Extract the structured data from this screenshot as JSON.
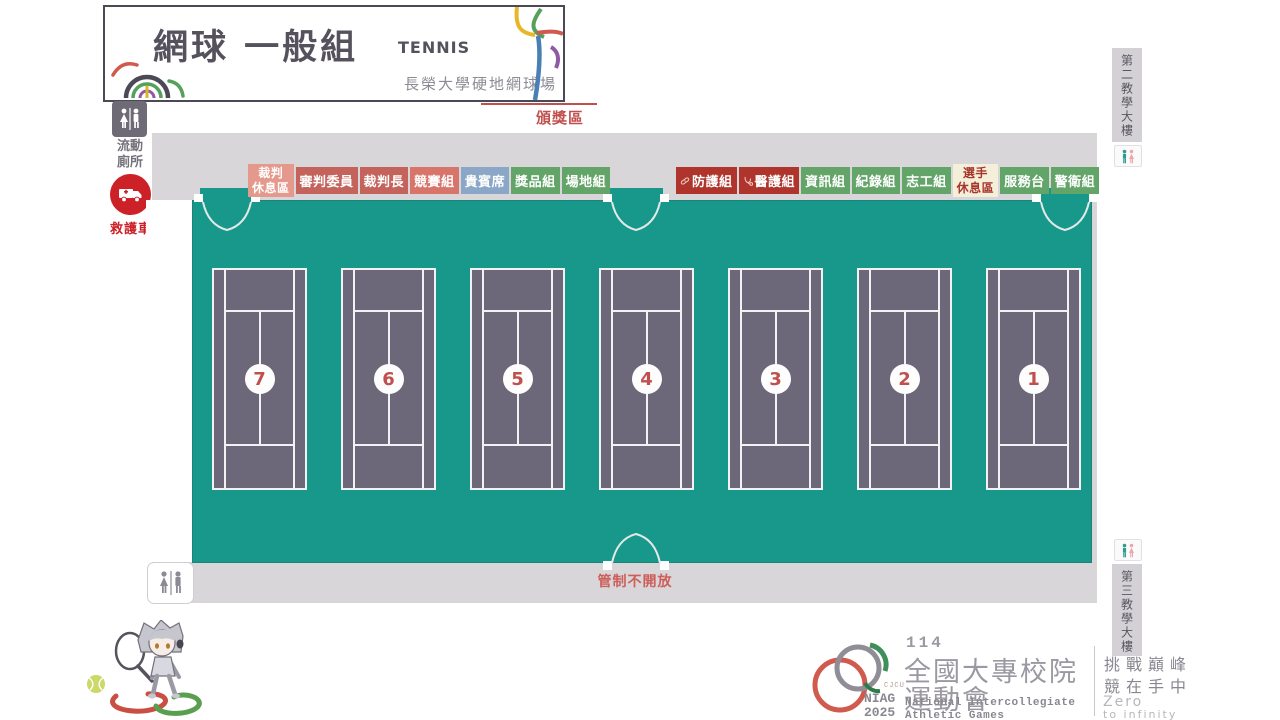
{
  "header": {
    "title": "網球 一般組",
    "subtitle_en": "TENNIS",
    "venue": "長榮大學硬地網球場"
  },
  "map": {
    "award_area": "頒獎區",
    "gate_closed": "管制不開放",
    "portable_toilet": {
      "line1": "流動",
      "line2": "廁所"
    },
    "ambulance": "救護車",
    "building_top": "第二教學大樓",
    "building_bottom": "第三教學大樓",
    "courts": [
      "7",
      "6",
      "5",
      "4",
      "3",
      "2",
      "1"
    ],
    "zones_left": [
      {
        "label": "裁判休息區",
        "lines": [
          "裁判",
          "休息區"
        ],
        "color": "#e5988c"
      },
      {
        "label": "審判委員",
        "color": "#c4635b"
      },
      {
        "label": "裁判長",
        "color": "#c4635b"
      },
      {
        "label": "競賽組",
        "color": "#d8756a"
      },
      {
        "label": "貴賓席",
        "color": "#8ba7c7"
      },
      {
        "label": "獎品組",
        "color": "#63a468"
      },
      {
        "label": "場地組",
        "color": "#63a468"
      }
    ],
    "zones_right": [
      {
        "label": "防護組",
        "color": "#ae342c",
        "icon": "bandage-icon"
      },
      {
        "label": "醫護組",
        "color": "#ae342c",
        "icon": "stethoscope-icon"
      },
      {
        "label": "資訊組",
        "color": "#63a468"
      },
      {
        "label": "紀錄組",
        "color": "#63a468"
      },
      {
        "label": "志工組",
        "color": "#63a468"
      },
      {
        "label": "選手休息區",
        "lines": [
          "選手",
          "休息區"
        ],
        "color": "#f4efd8",
        "text_color": "#a8342e"
      },
      {
        "label": "服務台",
        "color": "#63a468"
      },
      {
        "label": "警衛組",
        "color": "#63a468"
      }
    ]
  },
  "footer": {
    "cjcu": "CJCU",
    "niag": "NIAG",
    "year": "2025",
    "games_number": "114",
    "games_title_line1": "全國大專校院",
    "games_title_line2": "運動會",
    "games_en_line1": "National Intercollegiate",
    "games_en_line2": "Athletic Games",
    "slogan_line1": "挑戰巔峰",
    "slogan_line2": "競在手中",
    "slogan_en_line1": "Zero",
    "slogan_en_line2": "to infinity"
  },
  "colors": {
    "floor_teal": "#18988a",
    "court_surface": "#6c6879",
    "court_line": "#f2f1f4",
    "walkway_gray": "#d8d6d9",
    "court_number_red": "#c0504d",
    "ambulance_red": "#cb2127",
    "gate_text_red": "#cd5e59",
    "header_ink": "#55515d"
  }
}
